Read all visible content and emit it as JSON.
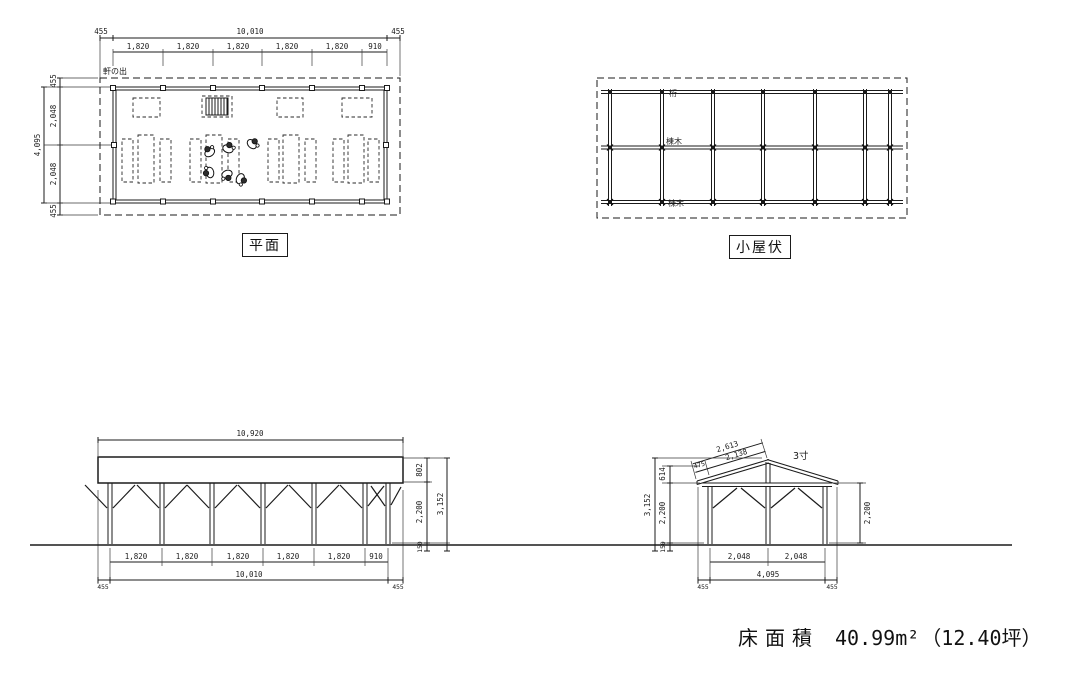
{
  "views": {
    "floor_plan": {
      "title": "平面",
      "eave_note": "軒の出",
      "top": {
        "overall": "10,010",
        "eave_l": "455",
        "eave_r": "455",
        "bays": [
          "1,820",
          "1,820",
          "1,820",
          "1,820",
          "1,820",
          "910"
        ]
      },
      "left": {
        "overall": "4,095",
        "eave_t": "455",
        "eave_b": "455",
        "bays": [
          "2,048",
          "2,048"
        ]
      }
    },
    "roof_plan": {
      "title": "小屋伏",
      "girder": "桁",
      "ridge": "棟木",
      "ridge2": "棟木"
    },
    "front_elevation": {
      "roof_width": "10,920",
      "right": {
        "fascia": "802",
        "wall": "2,200",
        "base": "150",
        "overall": "3,152"
      },
      "bottom": {
        "bays": [
          "1,820",
          "1,820",
          "1,820",
          "1,820",
          "1,820",
          "910"
        ],
        "overall": "10,010",
        "eave_l": "455",
        "eave_r": "455"
      }
    },
    "side_elevation": {
      "pitch": "3寸",
      "slope": {
        "overall": "2,613",
        "rafter": "2,138",
        "eave": "475"
      },
      "left": {
        "rise": "614",
        "wall": "2,200",
        "base": "150",
        "overall": "3,152"
      },
      "right_wall": "2,200",
      "bottom": {
        "bays": [
          "2,048",
          "2,048"
        ],
        "overall": "4,095",
        "eave_l": "455",
        "eave_r": "455"
      }
    }
  },
  "footer": {
    "label": "床面積",
    "area": "40.99m²",
    "tsubo": "（12.40坪）"
  }
}
